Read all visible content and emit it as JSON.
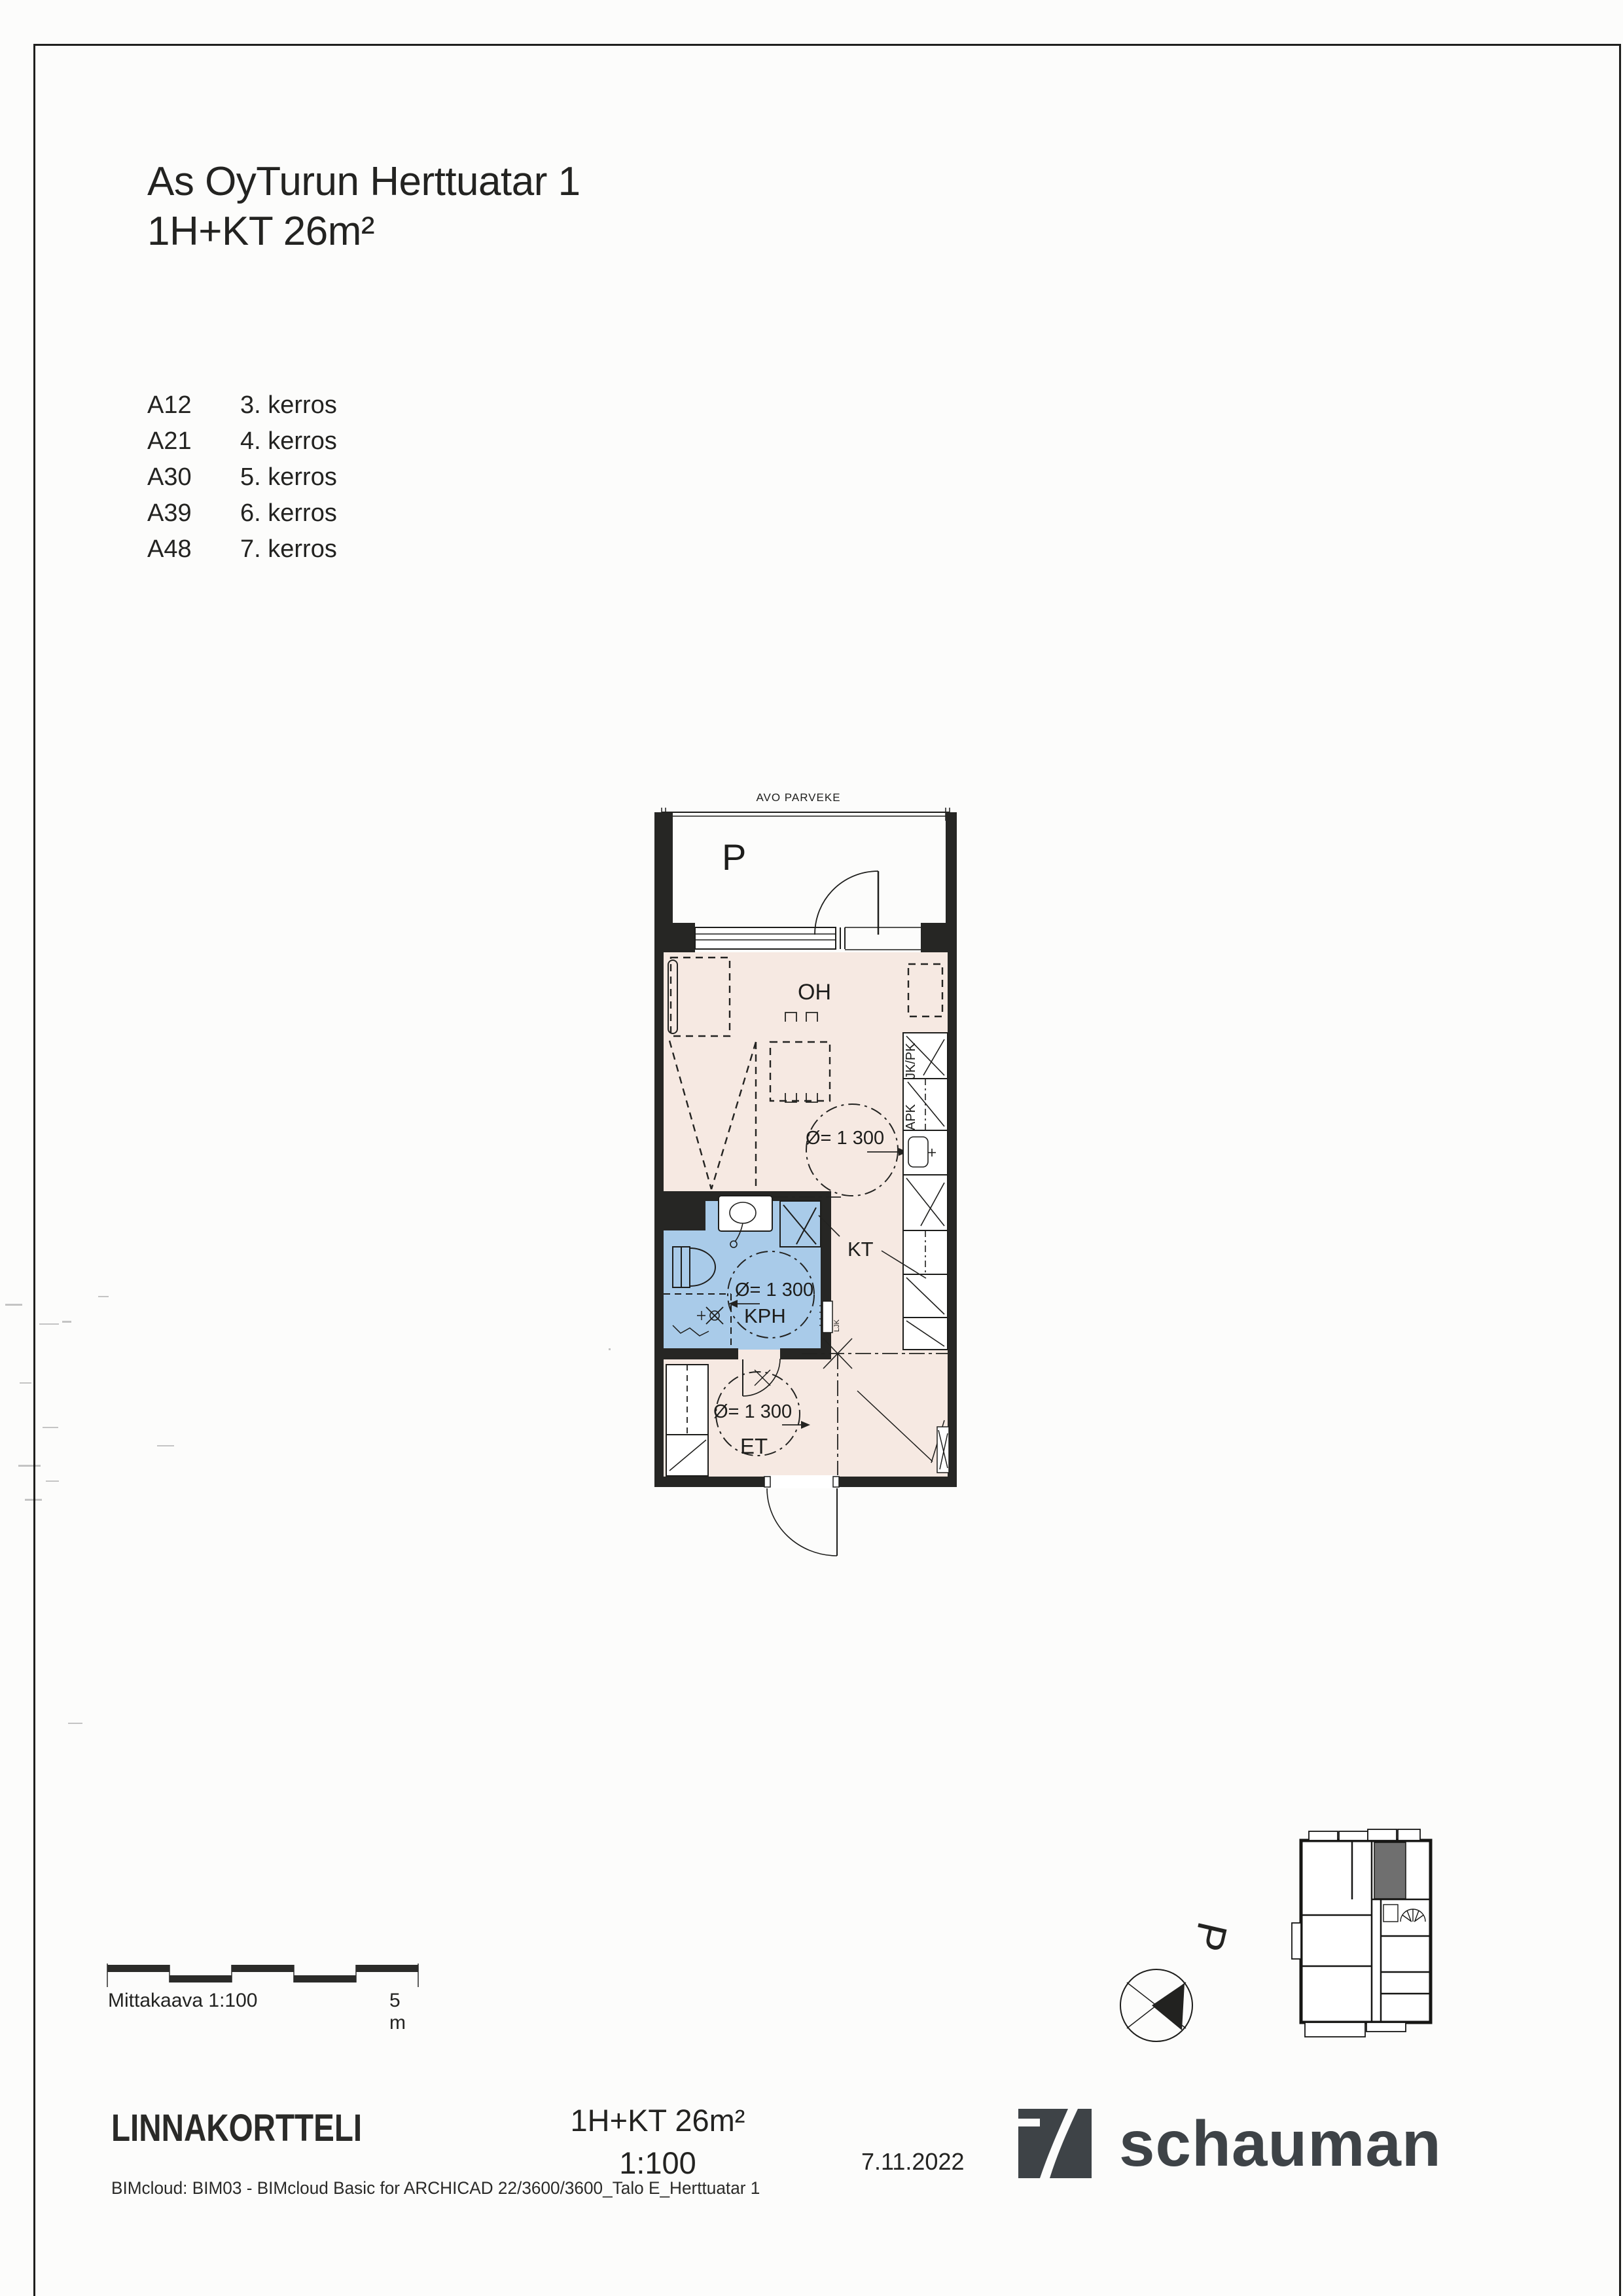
{
  "header": {
    "title_line1": "As OyTurun Herttuatar 1",
    "title_line2": "1H+KT 26m²"
  },
  "apartments": [
    {
      "code": "A12",
      "floor": "3. kerros"
    },
    {
      "code": "A21",
      "floor": "4. kerros"
    },
    {
      "code": "A30",
      "floor": "5. kerros"
    },
    {
      "code": "A39",
      "floor": "6. kerros"
    },
    {
      "code": "A48",
      "floor": "7. kerros"
    }
  ],
  "plan": {
    "balcony_header": "AVO PARVEKE",
    "balcony_label": "P",
    "living_room": "OH",
    "kitchen": "KT",
    "bathroom": "KPH",
    "entry": "ET",
    "fridge_freezer": "JK/PK",
    "dishwasher": "APK",
    "utility_cabinet": "LJK",
    "turning_circle": "Ø= 1 300"
  },
  "scalebar": {
    "label": "Mittakaava 1:100",
    "end_label": "5 m"
  },
  "compass": {
    "north_label": "P"
  },
  "titleblock": {
    "project": "LINNAKORTTELI",
    "apartment_type": "1H+KT 26m²",
    "scale": "1:100",
    "date": "7.11.2022",
    "bim_info": "BIMcloud: BIM03 - BIMcloud Basic for ARCHICAD 22/3600/3600_Talo E_Herttuatar 1",
    "logo_text": "schauman"
  },
  "colors": {
    "wall": "#262624",
    "floor_pink": "#f6e9e2",
    "bath_blue": "#a9cbe9",
    "logo_gray": "#3e4347",
    "keyplan_hatch": "#6f6f6f"
  }
}
